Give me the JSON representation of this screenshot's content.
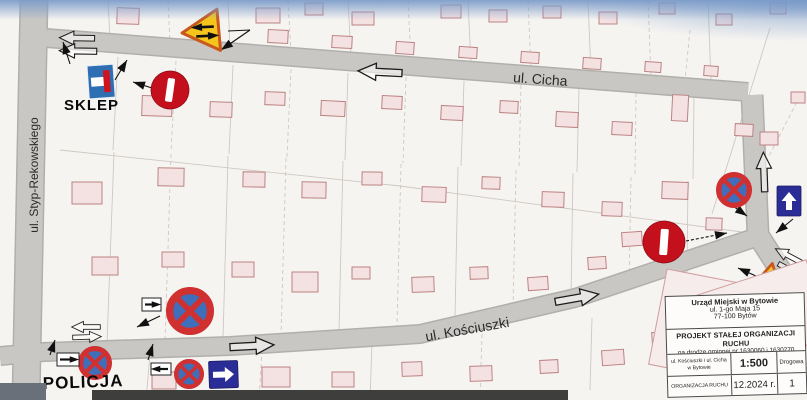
{
  "meta": {
    "width": 807,
    "height": 400
  },
  "colors": {
    "road_fill": "#c9c7c4",
    "road_edge": "#b1afac",
    "building_fill": "#f4e1e1",
    "building_stroke": "#bc8383",
    "parcel_line": "#ccc6c1",
    "sign_red": "#c4101d",
    "sign_blue_disc": "#3f6fba",
    "sign_ring_red": "#d03030",
    "sign_navy": "#2b2d96",
    "sign_yellow": "#f6c51d",
    "sign_yellow_border": "#c8581c",
    "dead_end_blue": "#2e6fb4"
  },
  "map": {
    "roads": [
      {
        "pts": [
          [
            34,
            0
          ],
          [
            26,
            400
          ]
        ],
        "w": 26
      },
      {
        "pts": [
          [
            46,
            38
          ],
          [
            748,
            92
          ]
        ],
        "w": 17
      },
      {
        "pts": [
          [
            752,
            95
          ],
          [
            758,
            235
          ],
          [
            807,
            312
          ]
        ],
        "w": 20
      },
      {
        "pts": [
          [
            0,
            356
          ],
          [
            44,
            352
          ],
          [
            230,
            346
          ],
          [
            420,
            334
          ],
          [
            575,
            298
          ],
          [
            757,
            237
          ]
        ],
        "w": 17
      }
    ],
    "parcel_lines": [
      [
        108,
        0,
        110,
        40,
        0
      ],
      [
        168,
        0,
        170,
        44,
        1
      ],
      [
        228,
        0,
        230,
        48,
        0
      ],
      [
        288,
        0,
        291,
        52,
        1
      ],
      [
        348,
        0,
        351,
        57,
        0
      ],
      [
        408,
        0,
        411,
        61,
        1
      ],
      [
        468,
        0,
        471,
        65,
        0
      ],
      [
        528,
        0,
        531,
        70,
        1
      ],
      [
        588,
        0,
        591,
        74,
        0
      ],
      [
        648,
        0,
        651,
        78,
        1
      ],
      [
        708,
        0,
        711,
        82,
        0
      ],
      [
        118,
        57,
        113,
        150,
        0
      ],
      [
        176,
        61,
        171,
        152,
        1
      ],
      [
        233,
        65,
        229,
        154,
        0
      ],
      [
        291,
        69,
        287,
        157,
        1
      ],
      [
        348,
        73,
        345,
        160,
        0
      ],
      [
        406,
        77,
        403,
        163,
        1
      ],
      [
        464,
        81,
        461,
        166,
        0
      ],
      [
        521,
        85,
        519,
        169,
        1
      ],
      [
        579,
        89,
        577,
        172,
        0
      ],
      [
        636,
        93,
        635,
        176,
        1
      ],
      [
        694,
        97,
        693,
        179,
        0
      ],
      [
        60,
        150,
        400,
        186,
        0
      ],
      [
        400,
        186,
        742,
        232,
        0
      ],
      [
        114,
        152,
        107,
        344,
        0
      ],
      [
        171,
        154,
        165,
        342,
        1
      ],
      [
        228,
        156,
        223,
        339,
        0
      ],
      [
        286,
        158,
        281,
        335,
        1
      ],
      [
        343,
        161,
        339,
        330,
        0
      ],
      [
        401,
        164,
        397,
        326,
        1
      ],
      [
        458,
        167,
        455,
        318,
        0
      ],
      [
        516,
        170,
        513,
        308,
        1
      ],
      [
        573,
        173,
        571,
        297,
        0
      ],
      [
        631,
        177,
        629,
        286,
        1
      ],
      [
        688,
        181,
        687,
        272,
        0
      ],
      [
        150,
        354,
        146,
        400,
        0
      ],
      [
        262,
        350,
        259,
        400,
        1
      ],
      [
        372,
        342,
        370,
        400,
        0
      ],
      [
        482,
        334,
        480,
        400,
        1
      ],
      [
        592,
        318,
        590,
        390,
        0
      ],
      [
        770,
        28,
        712,
        214,
        0
      ],
      [
        800,
        96,
        768,
        158,
        1
      ],
      [
        690,
        30,
        684,
        90,
        1
      ]
    ],
    "buildings": [
      [
        117,
        8,
        22,
        16,
        2
      ],
      [
        256,
        8,
        24,
        15,
        0
      ],
      [
        305,
        3,
        18,
        12,
        0
      ],
      [
        352,
        12,
        22,
        13,
        0
      ],
      [
        441,
        5,
        20,
        13,
        0
      ],
      [
        489,
        10,
        18,
        12,
        0
      ],
      [
        543,
        6,
        18,
        12,
        0
      ],
      [
        599,
        12,
        18,
        12,
        0
      ],
      [
        659,
        3,
        16,
        11,
        0
      ],
      [
        716,
        14,
        16,
        11,
        0
      ],
      [
        770,
        3,
        16,
        11,
        0
      ],
      [
        268,
        30,
        20,
        13,
        3
      ],
      [
        332,
        36,
        20,
        12,
        3
      ],
      [
        396,
        42,
        18,
        12,
        4
      ],
      [
        459,
        47,
        18,
        11,
        4
      ],
      [
        521,
        52,
        18,
        11,
        4
      ],
      [
        583,
        58,
        18,
        11,
        4
      ],
      [
        645,
        62,
        16,
        10,
        4
      ],
      [
        704,
        66,
        14,
        10,
        4
      ],
      [
        142,
        96,
        30,
        20,
        2
      ],
      [
        210,
        102,
        22,
        15,
        2
      ],
      [
        265,
        92,
        20,
        13,
        2
      ],
      [
        321,
        101,
        24,
        15,
        3
      ],
      [
        382,
        96,
        20,
        13,
        3
      ],
      [
        441,
        106,
        22,
        14,
        3
      ],
      [
        500,
        101,
        18,
        12,
        3
      ],
      [
        556,
        112,
        22,
        15,
        3
      ],
      [
        612,
        122,
        20,
        13,
        3
      ],
      [
        672,
        95,
        16,
        26,
        3
      ],
      [
        735,
        124,
        18,
        12,
        3
      ],
      [
        791,
        92,
        14,
        11,
        0
      ],
      [
        72,
        182,
        30,
        22,
        0
      ],
      [
        158,
        168,
        26,
        18,
        1
      ],
      [
        243,
        172,
        22,
        15,
        1
      ],
      [
        302,
        182,
        24,
        16,
        1
      ],
      [
        362,
        172,
        20,
        13,
        1
      ],
      [
        422,
        187,
        24,
        15,
        2
      ],
      [
        482,
        177,
        18,
        12,
        2
      ],
      [
        542,
        192,
        22,
        15,
        2
      ],
      [
        602,
        202,
        20,
        14,
        2
      ],
      [
        662,
        182,
        26,
        17,
        2
      ],
      [
        706,
        218,
        16,
        12,
        2
      ],
      [
        760,
        132,
        18,
        13,
        0
      ],
      [
        92,
        257,
        26,
        18,
        0
      ],
      [
        162,
        252,
        22,
        15,
        0
      ],
      [
        232,
        262,
        22,
        15,
        0
      ],
      [
        292,
        272,
        26,
        20,
        0
      ],
      [
        352,
        267,
        18,
        12,
        0
      ],
      [
        412,
        277,
        22,
        15,
        -2
      ],
      [
        470,
        267,
        18,
        12,
        -2
      ],
      [
        528,
        277,
        20,
        13,
        -4
      ],
      [
        588,
        257,
        18,
        12,
        -4
      ],
      [
        622,
        232,
        20,
        14,
        -4
      ],
      [
        152,
        372,
        24,
        17,
        0
      ],
      [
        262,
        367,
        28,
        20,
        0
      ],
      [
        332,
        372,
        22,
        15,
        0
      ],
      [
        402,
        362,
        20,
        14,
        -2
      ],
      [
        470,
        366,
        22,
        15,
        -2
      ],
      [
        540,
        360,
        18,
        13,
        -3
      ],
      [
        602,
        350,
        22,
        15,
        -4
      ],
      [
        652,
        332,
        18,
        12,
        -4
      ]
    ],
    "road_arrows": [
      [
        77,
        38,
        181,
        0.8
      ],
      [
        78,
        51,
        181,
        0.85
      ],
      [
        380,
        72,
        183,
        1.0
      ],
      [
        577,
        298,
        -10,
        1.0
      ],
      [
        86,
        327,
        180,
        0.65
      ],
      [
        87,
        337,
        -2,
        0.65
      ],
      [
        252,
        346,
        -3,
        1.0
      ],
      [
        764,
        172,
        -92,
        0.9
      ],
      [
        789,
        256,
        -152,
        0.7
      ],
      [
        792,
        271,
        28,
        0.7
      ]
    ],
    "leader_arrows": [
      [
        70,
        64,
        63,
        42,
        0,
        1
      ],
      [
        115,
        80,
        127,
        60,
        0,
        1
      ],
      [
        152,
        88,
        133,
        82,
        0,
        1
      ],
      [
        228,
        31,
        250,
        30,
        0,
        0
      ],
      [
        250,
        30,
        221,
        50,
        0,
        1
      ],
      [
        50,
        355,
        55,
        340,
        0,
        1
      ],
      [
        148,
        360,
        153,
        344,
        0,
        1
      ],
      [
        160,
        316,
        137,
        327,
        0,
        1
      ],
      [
        733,
        206,
        747,
        216,
        0,
        1
      ],
      [
        686,
        241,
        727,
        233,
        1,
        1
      ],
      [
        793,
        219,
        776,
        233,
        0,
        1
      ],
      [
        756,
        276,
        738,
        268,
        0,
        1
      ]
    ],
    "signs": [
      {
        "type": "dead-end",
        "x": 87,
        "y": 66,
        "w": 26,
        "h": 33,
        "rot": -4
      },
      {
        "type": "no-entry",
        "x": 170,
        "y": 90,
        "r": 19,
        "rot": 8
      },
      {
        "type": "no-entry",
        "x": 664,
        "y": 242,
        "r": 21,
        "rot": 4
      },
      {
        "type": "no-stopping",
        "x": 190,
        "y": 311,
        "r": 24
      },
      {
        "type": "no-stopping",
        "x": 95,
        "y": 363,
        "r": 17
      },
      {
        "type": "no-stopping",
        "x": 189,
        "y": 374,
        "r": 15
      },
      {
        "type": "no-stopping",
        "x": 734,
        "y": 190,
        "r": 18
      },
      {
        "type": "one-way",
        "x": 209,
        "y": 361,
        "w": 29,
        "h": 27,
        "dir": "right",
        "rot": -2
      },
      {
        "type": "one-way",
        "x": 777,
        "y": 186,
        "w": 24,
        "h": 30,
        "dir": "up",
        "rot": 0
      },
      {
        "type": "plate",
        "x": 57,
        "y": 353,
        "w": 22,
        "h": 13,
        "dir": "right"
      },
      {
        "type": "plate",
        "x": 151,
        "y": 363,
        "w": 20,
        "h": 12,
        "dir": "left"
      },
      {
        "type": "plate",
        "x": 142,
        "y": 298,
        "w": 19,
        "h": 13,
        "dir": "right"
      },
      {
        "type": "two-way",
        "x": 205,
        "y": 31,
        "size": 46,
        "rot": -95,
        "top": "left",
        "arrRot": -3
      },
      {
        "type": "two-way",
        "x": 768,
        "y": 284,
        "size": 42,
        "rot": 12,
        "top": "right",
        "arrRot": -18
      }
    ],
    "street_labels": [
      {
        "text": "ul. Cicha",
        "x": 540,
        "y": 84,
        "rot": 4,
        "size": 14
      },
      {
        "text": "ul. Kościuszki",
        "x": 468,
        "y": 334,
        "rot": -10,
        "size": 14
      },
      {
        "text": "ul. Styp-Rekowskiego",
        "x": 38,
        "y": 175,
        "rot": -90,
        "size": 12
      }
    ],
    "place_labels": [
      {
        "text": "SKLEP",
        "x": 64,
        "y": 110,
        "rot": 0,
        "size": 15
      },
      {
        "text": "POLICJA",
        "x": 43,
        "y": 389,
        "rot": -2,
        "size": 17
      }
    ]
  },
  "title_block": {
    "office_lines": [
      "Urząd Miejski w Bytowie",
      "ul. 1-go Maja 15",
      "77-100 Bytów"
    ],
    "project_title": "PROJEKT STAŁEJ ORGANIZACJI RUCHU",
    "project_subtitle": "na drodze gminnej nr 1630060 i 1630270",
    "location_label": "ul. Kościuszki i ul. Cicha w Bytowie",
    "scale_label": "1:500",
    "branch_label": "Drogowa",
    "stage_label": "ORGANIZACJA RUCHU",
    "date_label": "12.2024 r.",
    "sheet_number": "1"
  }
}
